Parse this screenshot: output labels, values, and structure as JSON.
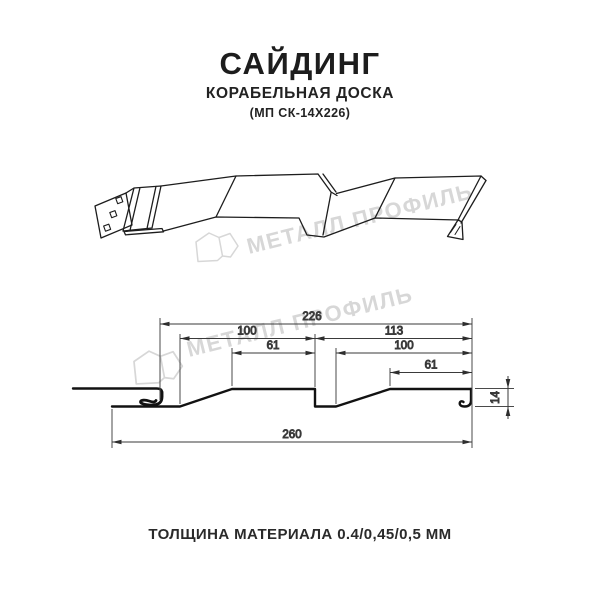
{
  "header": {
    "title": "САЙДИНГ",
    "subtitle": "КОРАБЕЛЬНАЯ ДОСКА",
    "product_code": "(МП СК-14Х226)"
  },
  "watermark": {
    "brand_text": "МЕТАЛЛ ПРОФИЛЬ",
    "color": "#d7d7d7"
  },
  "cross_section": {
    "dimensions": {
      "overall_top": "226",
      "left_panel_width": "100",
      "right_panel_width": "113",
      "left_panel_flat": "61",
      "right_panel_inner": "100",
      "right_panel_flat": "61",
      "total_width": "260",
      "profile_height": "14"
    }
  },
  "footer": {
    "thickness_note": "ТОЛЩИНА МАТЕРИАЛА 0.4/0,45/0,5 ММ"
  },
  "colors": {
    "line": "#1a1a1a",
    "dimension": "#333333",
    "watermark": "#d7d7d7",
    "background": "#ffffff"
  }
}
